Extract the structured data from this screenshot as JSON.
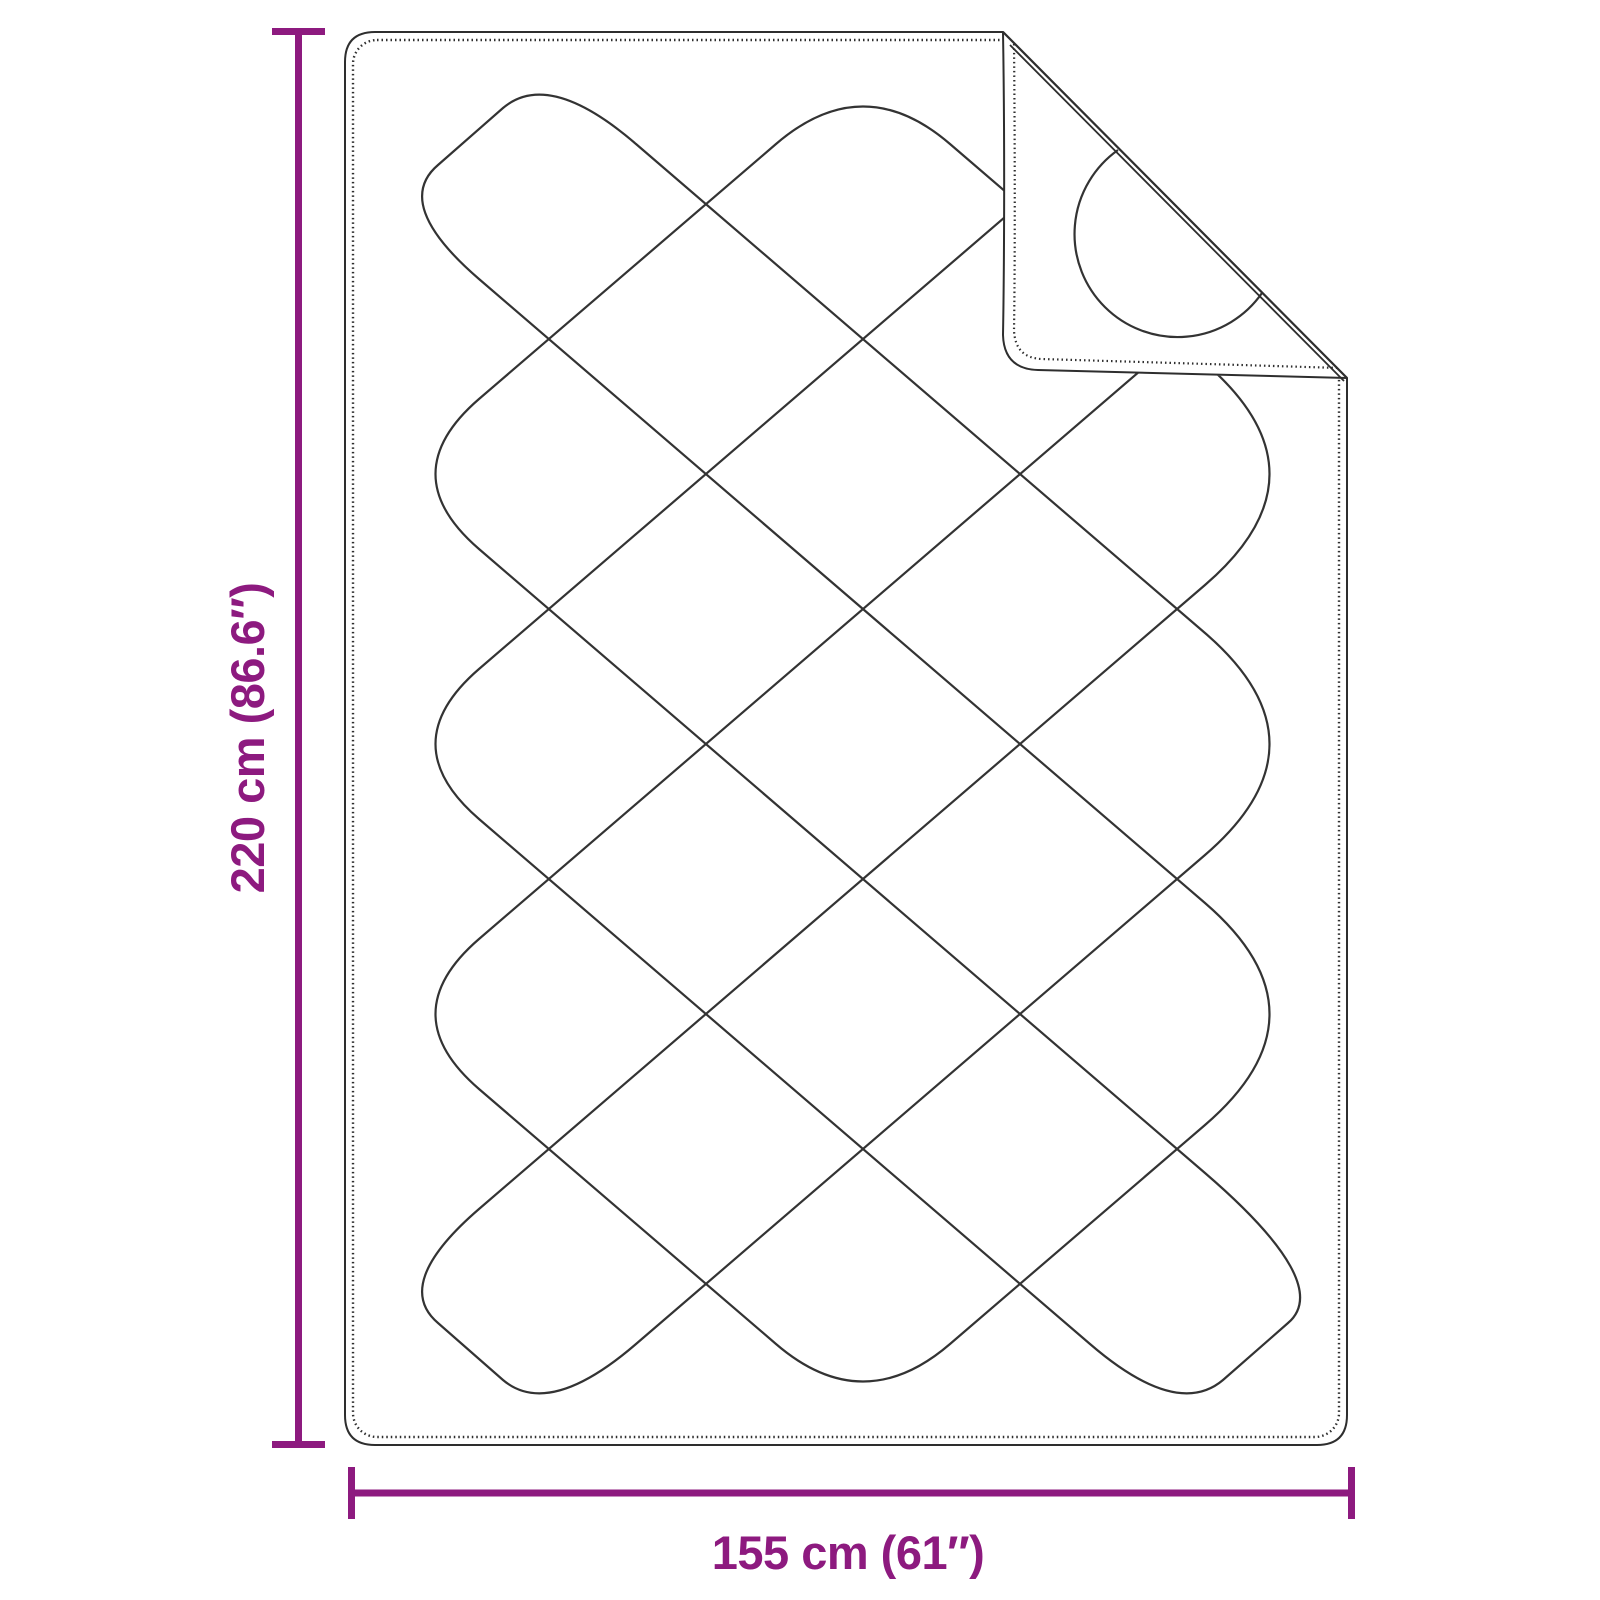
{
  "page": {
    "background_color": "#ffffff"
  },
  "diagram": {
    "kind": "product-dimension-diagram",
    "subject": "quilted blanket with folded-back corner",
    "line_color": "#2e2e2e",
    "accent_color": "#8d1a7f",
    "dimensions": {
      "height": {
        "label": "220 cm (86.6″)",
        "value_cm": 220,
        "value_inches": 86.6
      },
      "width": {
        "label": "155 cm (61″)",
        "value_cm": 155,
        "value_inches": 61
      }
    }
  }
}
